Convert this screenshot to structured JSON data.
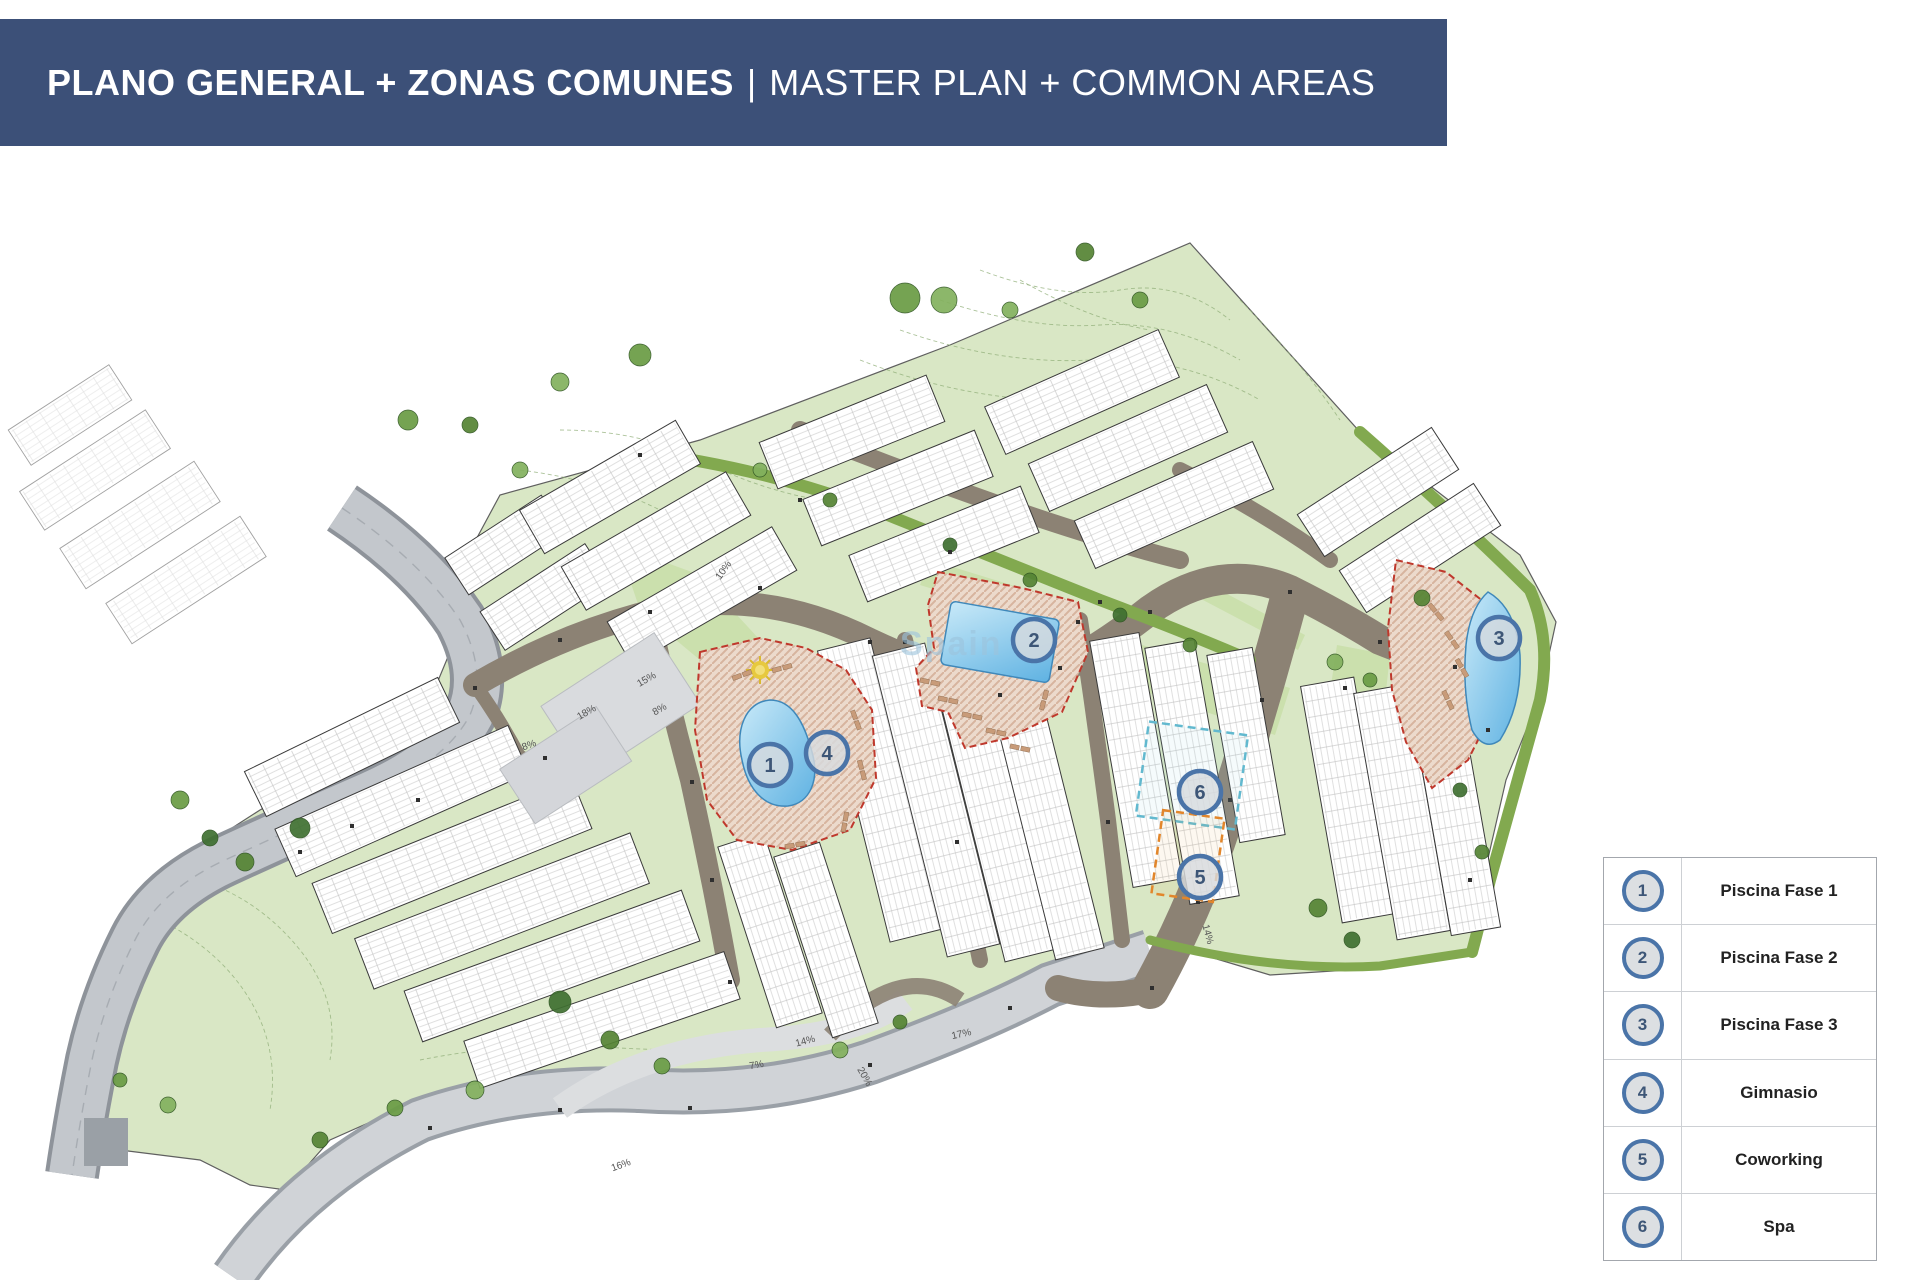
{
  "title": {
    "left": "PLANO GENERAL + ZONAS COMUNES",
    "separator": "|",
    "right": "MASTER PLAN + COMMON AREAS"
  },
  "legend": {
    "items": [
      {
        "number": "1",
        "label": "Piscina Fase 1"
      },
      {
        "number": "2",
        "label": "Piscina Fase 2"
      },
      {
        "number": "3",
        "label": "Piscina Fase 3"
      },
      {
        "number": "4",
        "label": "Gimnasio"
      },
      {
        "number": "5",
        "label": "Coworking"
      },
      {
        "number": "6",
        "label": "Spa"
      }
    ]
  },
  "plan": {
    "markers": [
      {
        "number": "1",
        "x": 770,
        "y": 765
      },
      {
        "number": "2",
        "x": 1034,
        "y": 640
      },
      {
        "number": "3",
        "x": 1499,
        "y": 638
      },
      {
        "number": "4",
        "x": 827,
        "y": 753
      },
      {
        "number": "5",
        "x": 1200,
        "y": 877
      },
      {
        "number": "6",
        "x": 1200,
        "y": 792
      }
    ],
    "watermark": "Spain",
    "slope_labels": [
      {
        "text": "10%",
        "x": 726,
        "y": 572,
        "rot": -55
      },
      {
        "text": "15%",
        "x": 648,
        "y": 682,
        "rot": -30
      },
      {
        "text": "8%",
        "x": 661,
        "y": 712,
        "rot": -30
      },
      {
        "text": "18%",
        "x": 588,
        "y": 715,
        "rot": -30
      },
      {
        "text": "8%",
        "x": 530,
        "y": 748,
        "rot": -20
      },
      {
        "text": "14%",
        "x": 806,
        "y": 1044,
        "rot": -15
      },
      {
        "text": "7%",
        "x": 757,
        "y": 1068,
        "rot": -10
      },
      {
        "text": "17%",
        "x": 962,
        "y": 1037,
        "rot": -12
      },
      {
        "text": "20%",
        "x": 862,
        "y": 1078,
        "rot": 60
      },
      {
        "text": "14%",
        "x": 1205,
        "y": 935,
        "rot": 75
      },
      {
        "text": "16%",
        "x": 622,
        "y": 1168,
        "rot": -20
      }
    ]
  },
  "colors": {
    "title_bar": "#3C5078",
    "marker_ring": "#4A74A8",
    "marker_fill": "#D7DADE",
    "marker_text": "#3D5677",
    "site_green": "#D9E7C5",
    "lawn_green": "#CBE0AD",
    "hedge_green": "#82A94F",
    "road_gray": "#C3C7CC",
    "road_brown": "#8C8274",
    "pool_blue": "#7EC6EC",
    "deck_tan": "#ECDACC",
    "red_dash": "#BF382C",
    "spa_dash": "#62B9CF",
    "coworking_dash": "#E2862B"
  }
}
